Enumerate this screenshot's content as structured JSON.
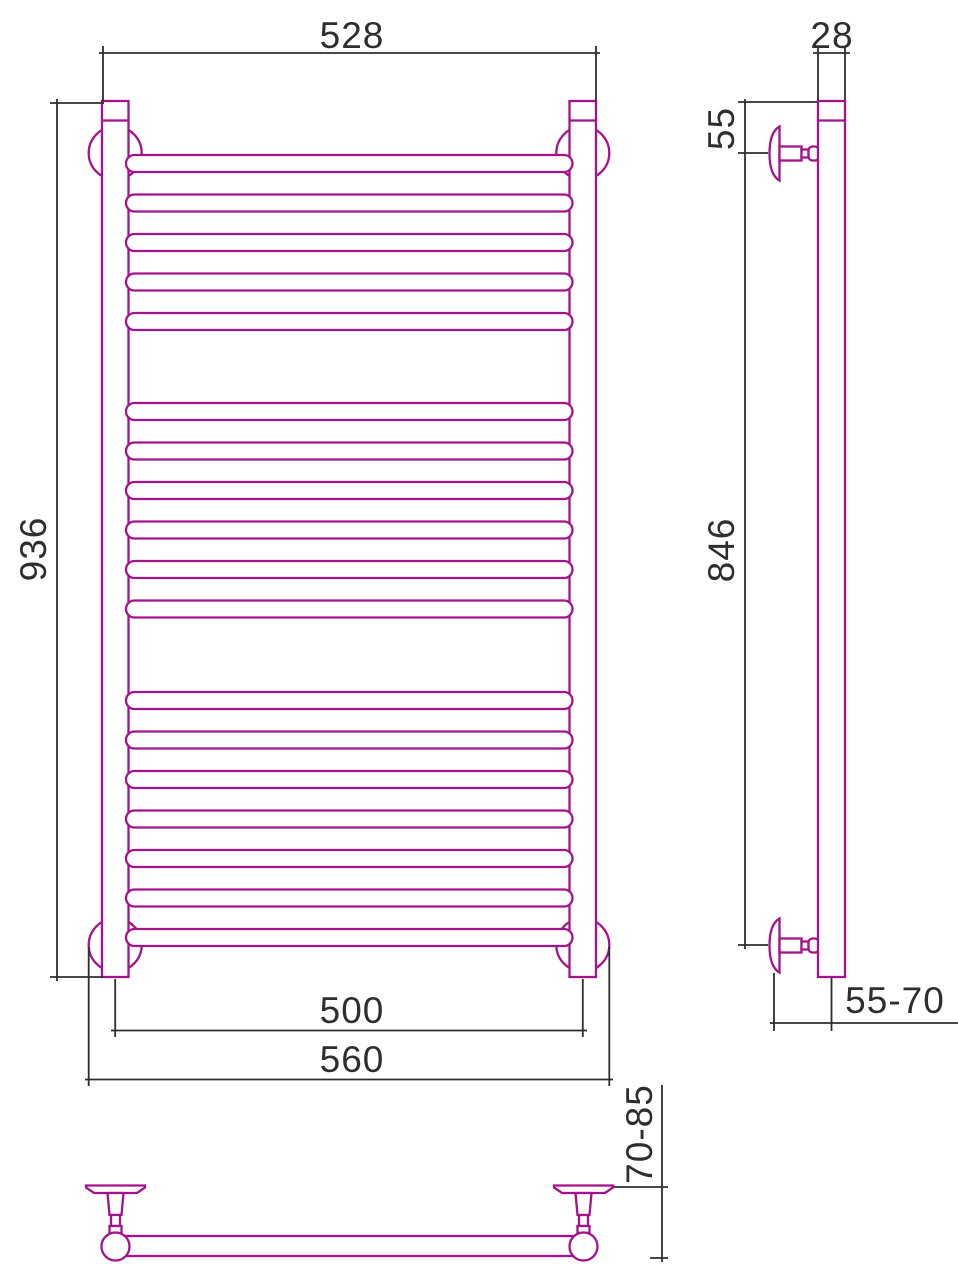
{
  "drawing": {
    "type": "heated-towel-rail-technical-drawing",
    "units_shown": "mm"
  },
  "colors": {
    "profile_magenta": "#a4138b",
    "dimension_black": "#2e2e2e",
    "background": "#ffffff"
  },
  "dimensions": {
    "top_width": "528",
    "depth": "28",
    "overall_height": "936",
    "top_bracket_offset": "55",
    "bracket_span": "846",
    "axis_width": "500",
    "flange_width": "560",
    "wall_to_axis": "55-70",
    "wall_to_front": "70-85"
  },
  "front_view": {
    "rungs": {
      "x": 126,
      "width": 446.5,
      "height": 17,
      "spacing": 39.5,
      "groups": [
        {
          "top": 155,
          "count": 5
        },
        {
          "top": 403,
          "count": 6
        },
        {
          "top": 692,
          "count": 7
        }
      ]
    }
  }
}
